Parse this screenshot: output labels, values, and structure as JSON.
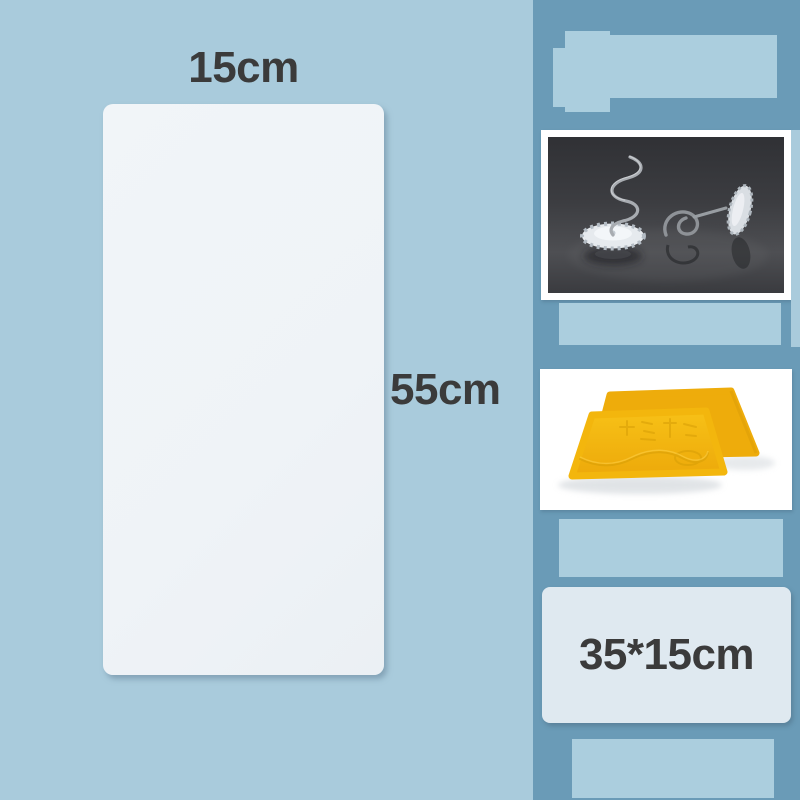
{
  "labels": {
    "panel_width": "15cm",
    "panel_height": "55cm",
    "scraper_size": "35*15cm"
  },
  "colors": {
    "background": "#a9cbdc",
    "sidebar": "#6a9bb7",
    "placeholder": "#abcede",
    "panel": "#eff3f7",
    "size_panel": "#dfe9f0",
    "text": "#3b3b3b",
    "scraper_yellow": "#f4b70e",
    "photo_dark_bg": "#3c3d41"
  },
  "photos": {
    "pins": {
      "name": "twist-pins-photo",
      "alt": "two spiral twist pins with clear flower-shaped heads on dark background"
    },
    "scrapers": {
      "name": "yellow-scrapers-photo",
      "alt": "two yellow trapezoid film scraper tools on white background"
    }
  }
}
